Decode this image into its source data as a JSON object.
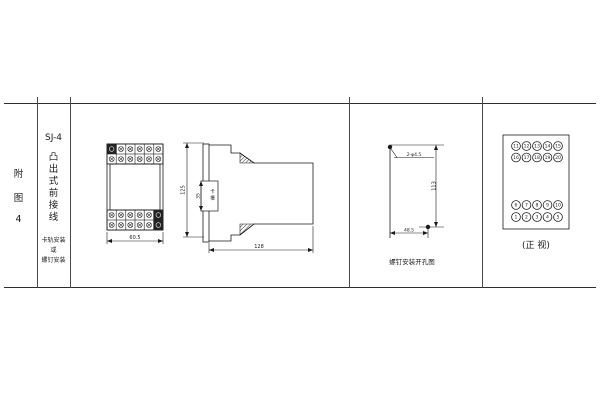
{
  "meta": {
    "background": "#ffffff",
    "line_color": "#2e2e2e"
  },
  "index_column": {
    "chars": [
      "附",
      "图",
      "4"
    ]
  },
  "title_column": {
    "model": "SJ-4",
    "title_chars": [
      "凸",
      "出",
      "式",
      "前",
      "接",
      "线"
    ],
    "note_lines": [
      "卡轨安装",
      "或",
      "螺钉安装"
    ]
  },
  "front_view": {
    "width_dim": "60.5"
  },
  "side_view": {
    "height_dim": "125",
    "slot_dim": "35",
    "slot_label_chars": [
      "卡",
      "槽"
    ],
    "depth_dim": "128"
  },
  "drill_view": {
    "holes_label": "2-φ4.5",
    "height_dim": "113",
    "width_dim": "48.5",
    "caption": "螺钉安装开孔图"
  },
  "terminal_view": {
    "rows": {
      "top1": [
        "11",
        "12",
        "13",
        "14",
        "15"
      ],
      "top2": [
        "16",
        "17",
        "18",
        "19",
        "20"
      ],
      "bottom1": [
        "6",
        "7",
        "8",
        "9",
        "10"
      ],
      "bottom2": [
        "1",
        "2",
        "3",
        "4",
        "5"
      ]
    },
    "caption": "(正 视)"
  }
}
